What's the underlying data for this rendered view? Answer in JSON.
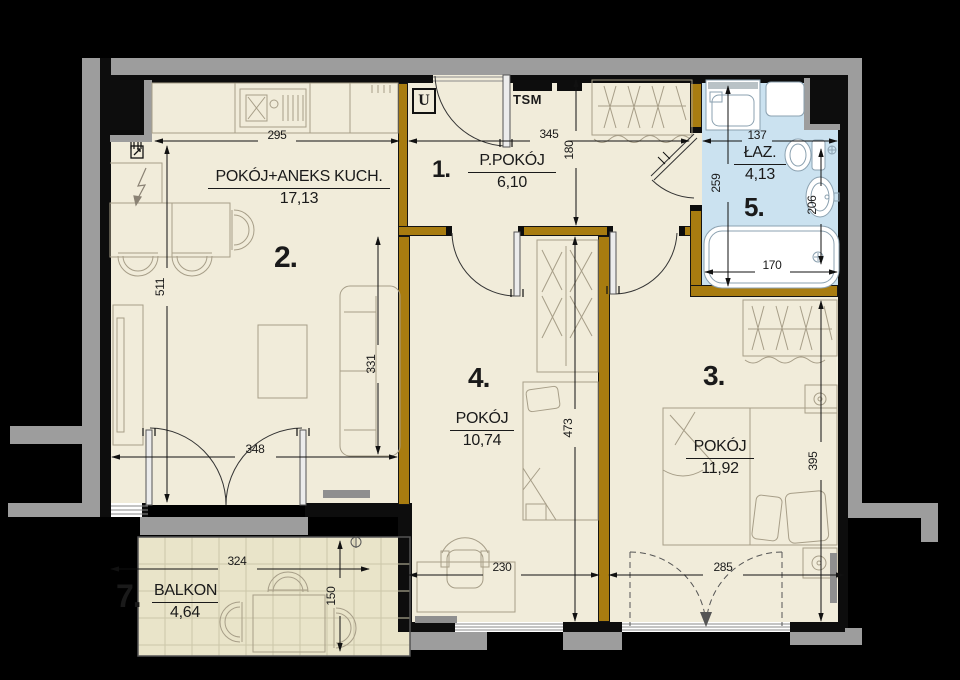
{
  "plan_title": "apartment floor plan",
  "rooms": {
    "r1": {
      "num": "1.",
      "name": "P.POKÓJ",
      "area": "6,10"
    },
    "r2": {
      "num": "2.",
      "name": "POKÓJ+ANEKS KUCH.",
      "area": "17,13"
    },
    "r3": {
      "num": "3.",
      "name": "POKÓJ",
      "area": "11,92"
    },
    "r4": {
      "num": "4.",
      "name": "POKÓJ",
      "area": "10,74"
    },
    "r5": {
      "num": "5.",
      "name": "ŁAZ.",
      "area": "4,13"
    },
    "r7": {
      "num": "7.",
      "name": "BALKON",
      "area": "4,64"
    }
  },
  "annotations": {
    "u": "U",
    "tsm": "TSM"
  },
  "dimensions_cm": {
    "d295": "295",
    "d345": "345",
    "d137": "137",
    "d180": "180",
    "d259": "259",
    "d206": "206",
    "d170": "170",
    "d511": "511",
    "d331": "331",
    "d473": "473",
    "d395": "395",
    "d348": "348",
    "d230": "230",
    "d285": "285",
    "d324": "324",
    "d150": "150"
  },
  "colors": {
    "floor": "#f1ecda",
    "bathroom_floor": "#cbe2f0",
    "balcony_floor": "#e9e4c9",
    "partition_wall": "#a87c10",
    "exterior_wall": "#0d0d0d",
    "neighbor_gray": "#9d9d9d"
  }
}
